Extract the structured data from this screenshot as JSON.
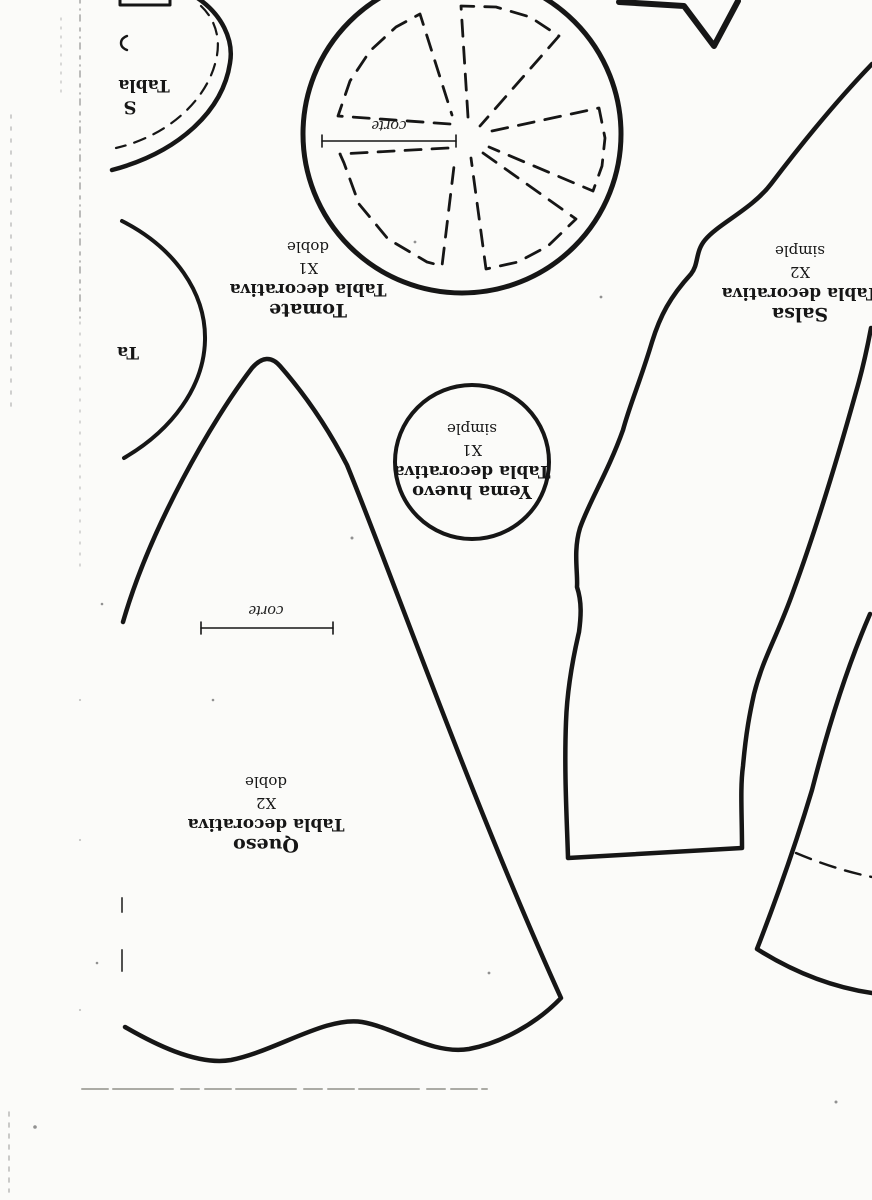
{
  "document": {
    "kind": "scanned craft pattern sheet",
    "language": "Spanish",
    "orientation_note": "all labels printed upside-down (rotated 180 degrees)"
  },
  "colors": {
    "ink": "#161616",
    "paper": "#fbfbf9",
    "faint_scan_line": "#979790"
  },
  "pieces": {
    "tomate": {
      "name": "Tomate",
      "type": "Tabla decorativa",
      "count": "X1",
      "mode": "doble",
      "cut_label": "corte"
    },
    "yema": {
      "name": "Yema huevo",
      "type": "Tabla decorativa",
      "count": "X1",
      "mode": "simple"
    },
    "salsa": {
      "name": "Salsa",
      "type": "Tabla decorativa",
      "count": "X2",
      "mode": "simple"
    },
    "queso": {
      "name": "Queso",
      "type": "Tabla decorativa",
      "count": "X2",
      "mode": "doble",
      "cut_label": "corte"
    },
    "partial_top_left": {
      "name_fragment": "S",
      "type_fragment": "Tabla"
    },
    "partial_left_arc": {
      "type_fragment": "Ta"
    }
  }
}
